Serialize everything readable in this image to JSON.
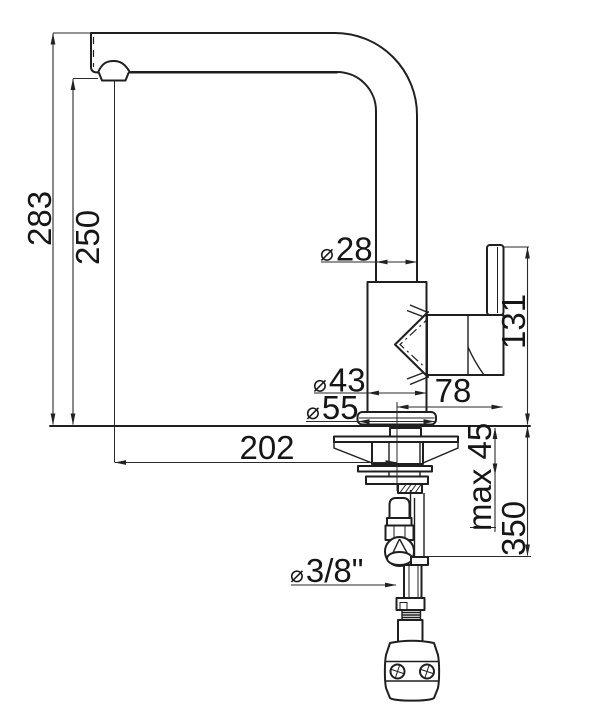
{
  "colors": {
    "ink": "#1f1f1f",
    "background": "#ffffff"
  },
  "labels": {
    "height_total": "283",
    "height_outlet": "250",
    "reach": "202",
    "spout_diameter": {
      "sym": "⌀",
      "val": "28"
    },
    "body_diameter": {
      "sym": "⌀",
      "val": "43"
    },
    "base_diameter": {
      "sym": "⌀",
      "val": "55"
    },
    "handle_top_height": "131",
    "handle_reach": "78",
    "deck_thickness_max": "max 45",
    "hose_length": "350",
    "connection_size": {
      "sym": "⌀",
      "val": "3/8\""
    }
  }
}
